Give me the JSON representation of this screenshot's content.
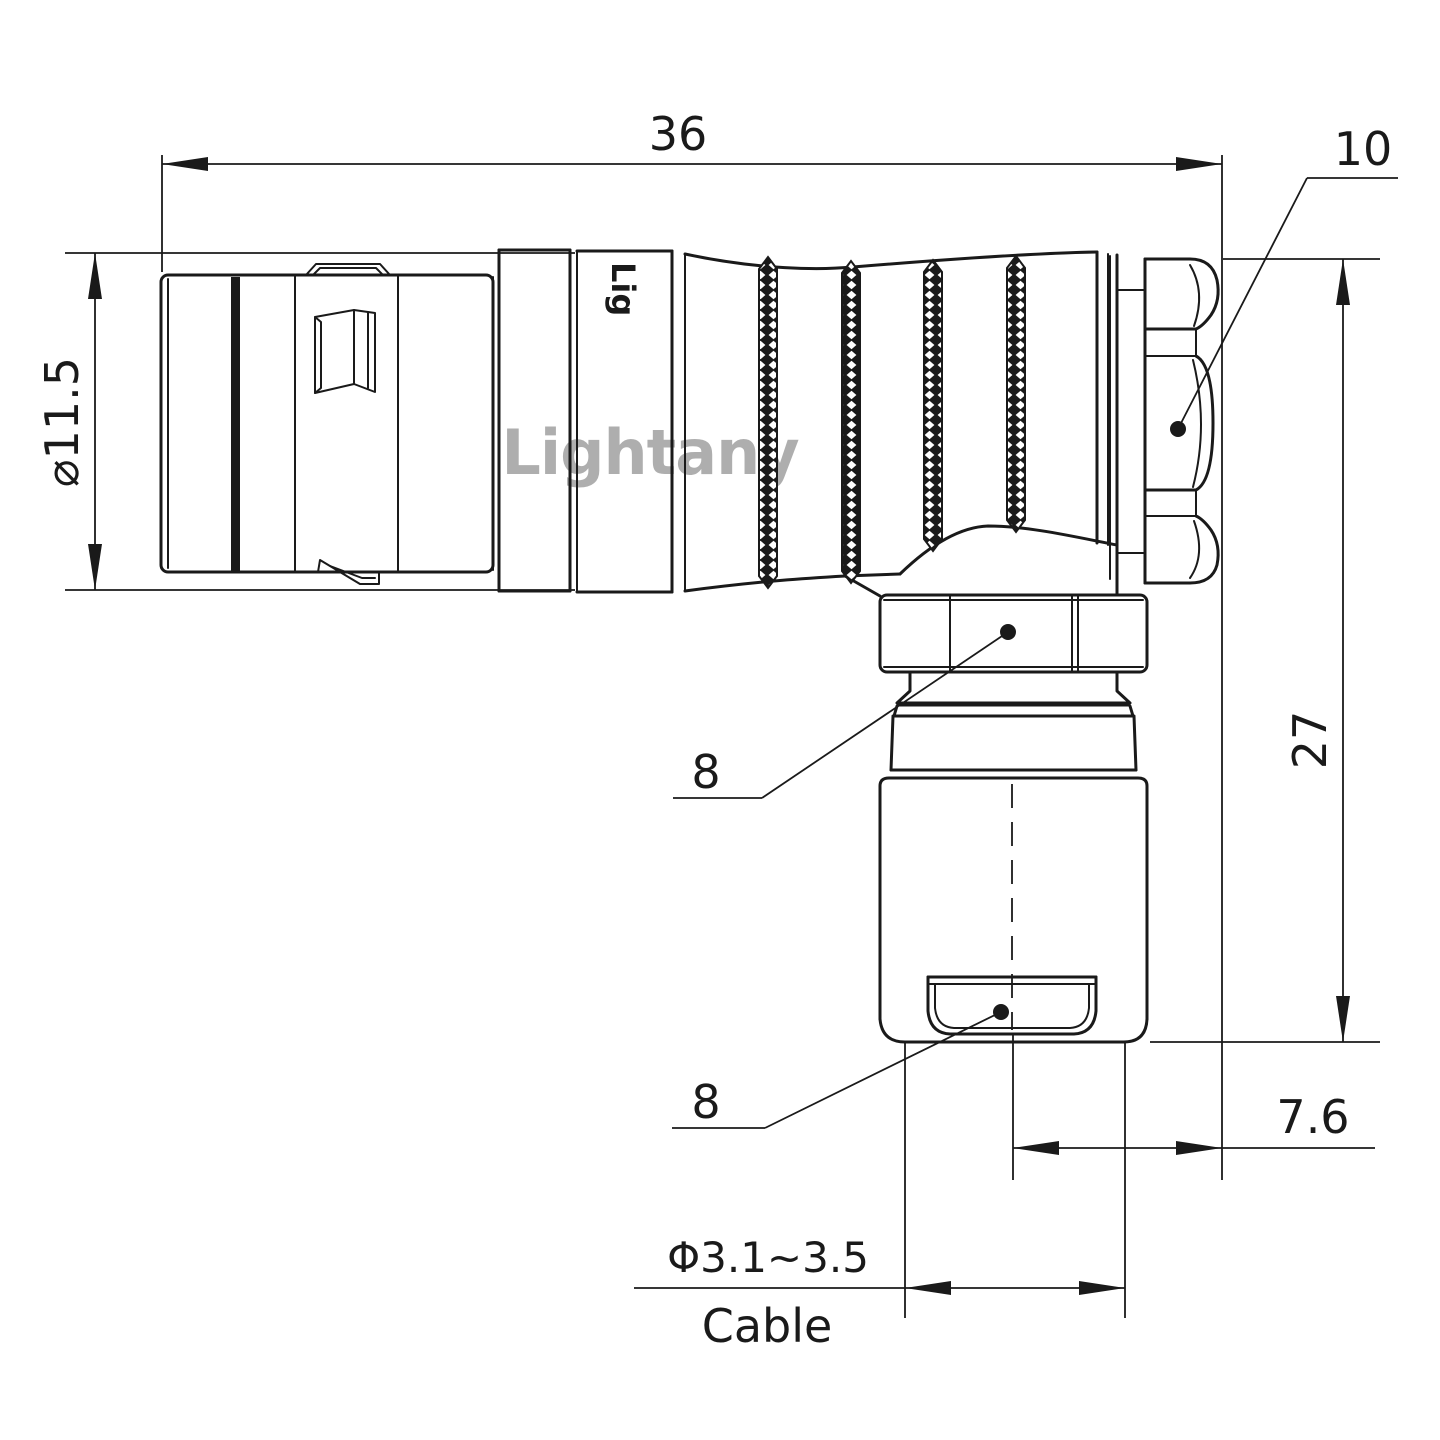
{
  "drawing": {
    "title_watermark": "Lightany",
    "body_engraving": "Lig",
    "colors": {
      "line": "#1a1a1a",
      "watermark": "#cd5a5a",
      "background": "#ffffff"
    },
    "dimensions": {
      "overall_length": "36",
      "shell_diameter": "⌀11.5",
      "rear_nut": "10",
      "elbow_height": "27",
      "hex_nut_upper": "8",
      "hex_nut_lower": "8",
      "center_offset": "7.6",
      "cable_diameter": "Φ3.1~3.5",
      "cable_label": "Cable"
    }
  }
}
